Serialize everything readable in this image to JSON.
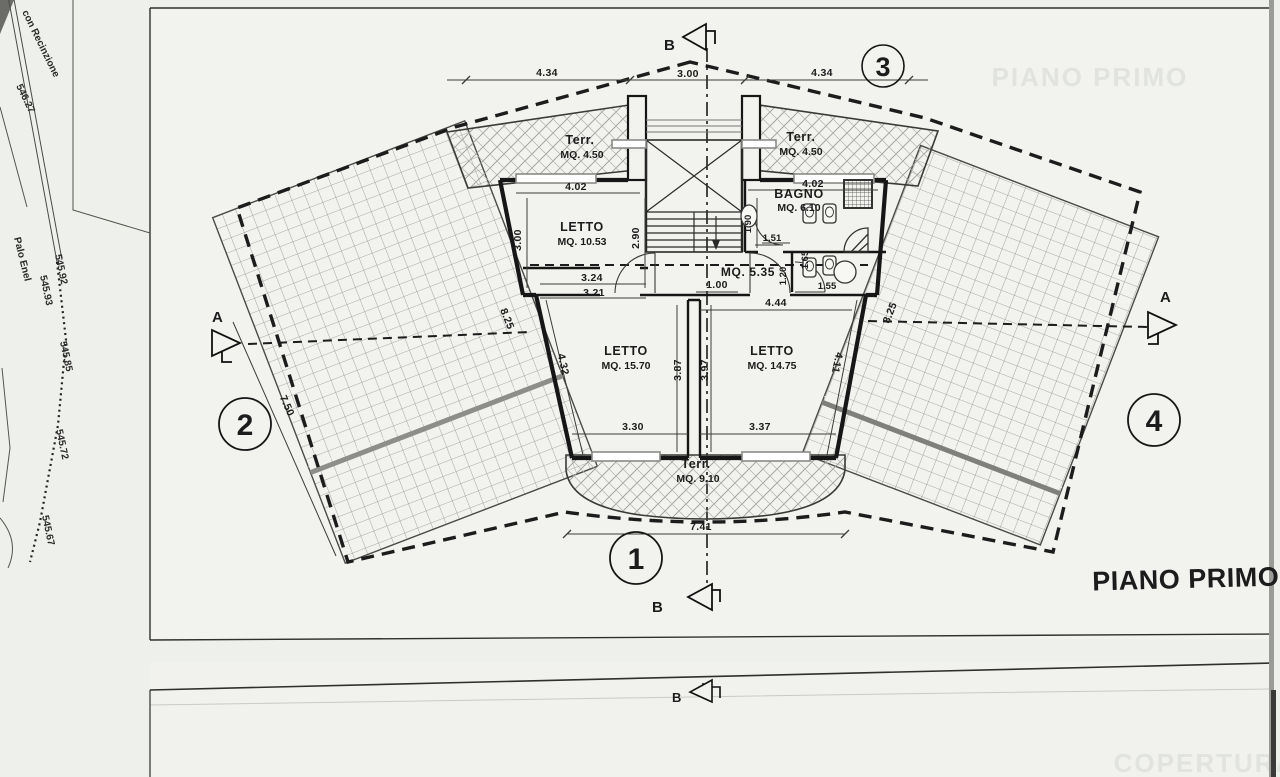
{
  "sheet": {
    "title": "PIANO PRIMO",
    "ghost_title_top": "PIANO PRIMO",
    "ghost_title_bottom": "COPERTURA"
  },
  "rooms": {
    "terr_left": {
      "name": "Terr.",
      "area": "MQ. 4.50"
    },
    "terr_right": {
      "name": "Terr.",
      "area": "MQ. 4.50"
    },
    "terr_bottom": {
      "name": "Terr.",
      "area": "MQ. 9.10"
    },
    "letto_nw": {
      "name": "LETTO",
      "area": "MQ. 10.53"
    },
    "bagno": {
      "name": "BAGNO",
      "area": "MQ. 6.10"
    },
    "corridoio": {
      "area": "MQ. 5.35"
    },
    "letto_sw": {
      "name": "LETTO",
      "area": "MQ. 15.70"
    },
    "letto_se": {
      "name": "LETTO",
      "area": "MQ. 14.75"
    }
  },
  "dims": {
    "top_left": "4.34",
    "top_mid": "3.00",
    "top_right": "4.34",
    "w_nw": "4.02",
    "w_bagno": "4.02",
    "h_nw_a": "3.00",
    "h_nw_b": "2.90",
    "h_bagno": "1.90",
    "bath_a": "1.51",
    "bath_b": "1.20",
    "bath_c": "1.65",
    "bath_d": "1.55",
    "corr_a": "3.24",
    "corr_b": "3.21",
    "corr_c": "1.00",
    "corr_d": "4.44",
    "sw_w": "3.30",
    "se_w": "3.37",
    "sw_h": "3.87",
    "se_h": "3.97",
    "sw_diag": "4.32",
    "se_diag": "4.11",
    "bottom": "7.41",
    "roof_left_len": "7.50",
    "roof_left_edge": "8.25",
    "roof_right_edge": "8.25"
  },
  "markers": {
    "section_a": "A",
    "section_b": "B",
    "node1": "1",
    "node2": "2",
    "node3": "3",
    "node4": "4"
  },
  "survey": {
    "fence_label": "con Recinzione",
    "fence_elev": "546.27",
    "pole": "Palo Enel",
    "elevations": [
      "545.92",
      "545.93",
      "545.85",
      "545.72",
      "545.67"
    ]
  },
  "colors": {
    "paper": "#f2f3ef",
    "ink": "#1c1c1c",
    "ghost": "#e1e3de",
    "hatch": "#8f908c"
  }
}
